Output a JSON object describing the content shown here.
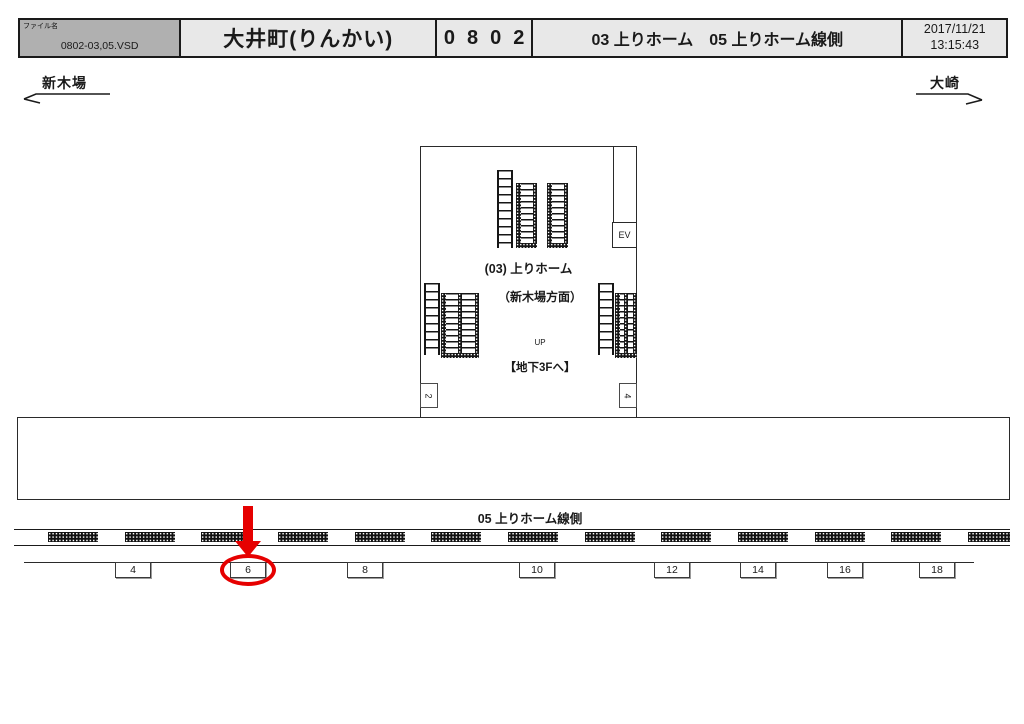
{
  "header": {
    "file_label": "ファイル名",
    "file_name": "0802-03,05.VSD",
    "station_name": "大井町(りんかい)",
    "location_code": "0802",
    "description": "03 上りホーム　05 上りホーム線側",
    "datetime_date": "2017/11/21",
    "datetime_time": "13:15:43"
  },
  "directions": {
    "west": "新木場",
    "east": "大崎"
  },
  "concourse": {
    "platform_label_line1": "(03) 上りホーム",
    "platform_label_line2": "（新木場方面）",
    "up_label": "UP",
    "basement_label": "【地下3Fへ】",
    "elevator_label": "EV",
    "column_left": "2",
    "column_right": "4"
  },
  "platform_edge": {
    "label": "05 上りホーム線側",
    "positions": [
      "4",
      "6",
      "8",
      "10",
      "12",
      "14",
      "16",
      "18"
    ],
    "highlighted_position": "6"
  },
  "colors": {
    "highlight_red": "#e60000",
    "header_file_bg": "#b0b0b0",
    "header_bg": "#e8e8e8",
    "line_color": "#1a1a1a"
  }
}
